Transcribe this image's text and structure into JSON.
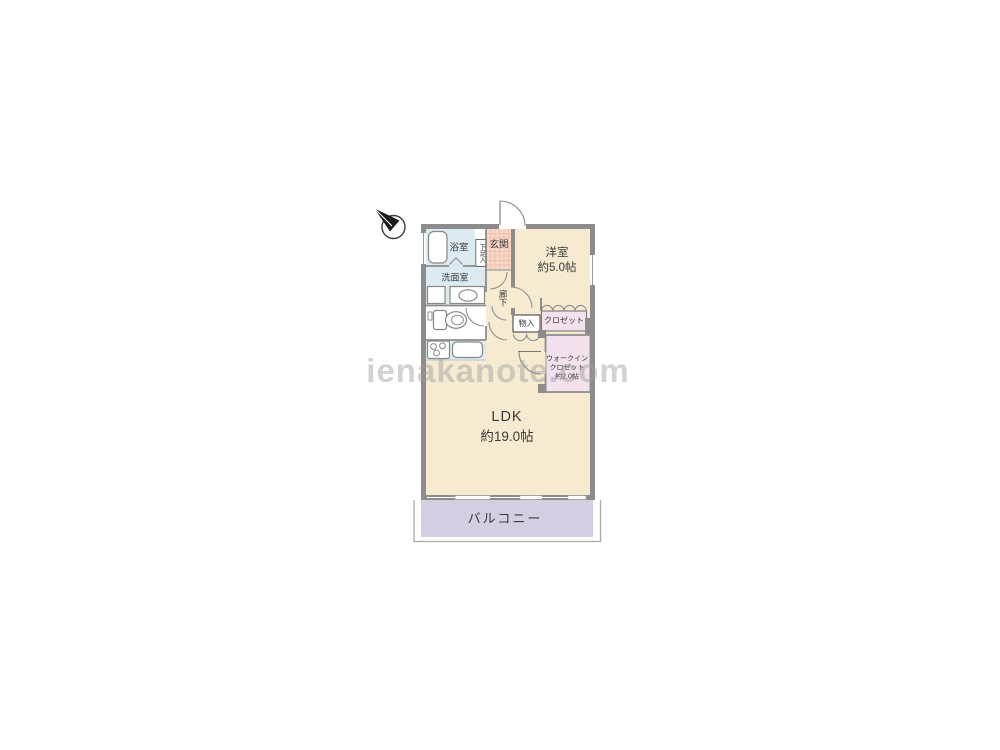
{
  "watermark": "ienakanote.com",
  "icons": {
    "compass": "north-arrow-compass"
  },
  "rooms": {
    "bathroom": {
      "label": "浴室"
    },
    "shoe_cupboard": {
      "label": "下足入"
    },
    "entrance": {
      "label": "玄関"
    },
    "washroom": {
      "label": "洗面室"
    },
    "hallway": {
      "label": "廊下"
    },
    "western_room": {
      "label": "洋室",
      "size": "約5.0帖"
    },
    "storage": {
      "label": "物入"
    },
    "closet": {
      "label": "クロゼット"
    },
    "walk_in_closet": {
      "label_line1": "ウォークイン",
      "label_line2": "クロゼット",
      "size": "約2.0帖"
    },
    "ldk": {
      "label": "LDK",
      "size": "約19.0帖"
    },
    "balcony": {
      "label": "バルコニー"
    }
  },
  "colors": {
    "room_cream": "#f6ebd1",
    "wet_area_blue": "#dcebf2",
    "entrance_tile": "#f9d8c7",
    "entrance_tile_grid": "#e9bba6",
    "closet_pink": "#f3e2ee",
    "balcony_lavender": "#d5cde1",
    "wall_gray": "#8c8c8c",
    "fixture_stroke": "#878787"
  }
}
